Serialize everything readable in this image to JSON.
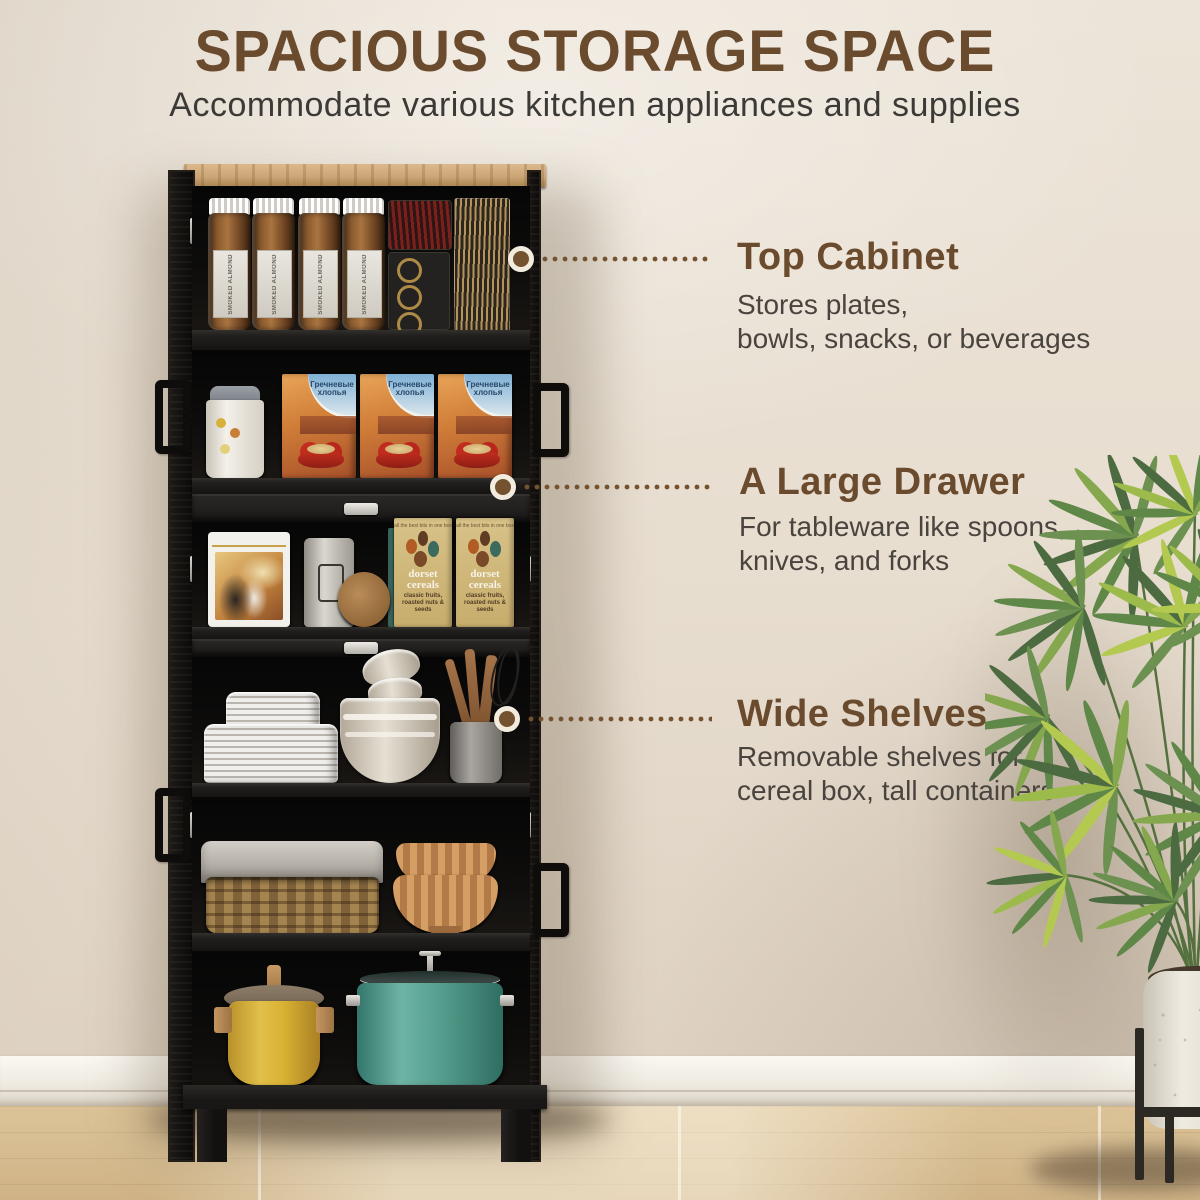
{
  "header": {
    "title": "SPACIOUS STORAGE SPACE",
    "subtitle": "Accommodate various kitchen appliances and supplies"
  },
  "callouts": [
    {
      "title": "Top Cabinet",
      "desc_line1": "Stores plates,",
      "desc_line2": "bowls, snacks, or beverages"
    },
    {
      "title": "A Large Drawer",
      "desc_line1": "For tableware like spoons,",
      "desc_line2": "knives, and forks"
    },
    {
      "title": "Wide Shelves",
      "desc_line1": "Removable shelves for",
      "desc_line2": "cereal box, tall containers"
    }
  ],
  "cabinet": {
    "jar_label": "SMOKED ALMOND",
    "cereal_box_label": "Гречневые хлопья",
    "dorset_box": {
      "brand": "dorset cereals",
      "flavor": "classic fruits, roasted nuts & seeds",
      "tagline": "all the best bits in one box"
    },
    "shelves": [
      {
        "name": "top-cabinet",
        "items": [
          "smoked almond jars",
          "pasta container",
          "ring container",
          "spaghetti container"
        ]
      },
      {
        "name": "second-shelf",
        "items": [
          "white canister",
          "three cereal boxes"
        ]
      },
      {
        "name": "third-shelf",
        "items": [
          "illustrated tin",
          "embossed canister",
          "round wooden board",
          "dorset cereals boxes"
        ]
      },
      {
        "name": "fourth-shelf",
        "items": [
          "plate stacks",
          "nesting bowls",
          "utensil crock with wooden utensils and whisk"
        ]
      },
      {
        "name": "fifth-shelf",
        "items": [
          "wicker basket with fabric liner",
          "two ribbed terracotta bowls"
        ]
      },
      {
        "name": "bottom-shelf",
        "items": [
          "yellow dutch oven",
          "teal stock pot with glass lid"
        ]
      }
    ]
  },
  "scene": {
    "plant": "potted-palm-plant",
    "wall": "beige-wall",
    "baseboard": "white-baseboard",
    "floor": "wood-plank-floor"
  },
  "colors": {
    "accent": "#6b4b2e",
    "text": "#49433e",
    "wall": "#e9e0d3",
    "cabinet": "#161412",
    "wood_top": "#cba677",
    "floor": "#d7bd92",
    "dot_line": "#74522f"
  }
}
